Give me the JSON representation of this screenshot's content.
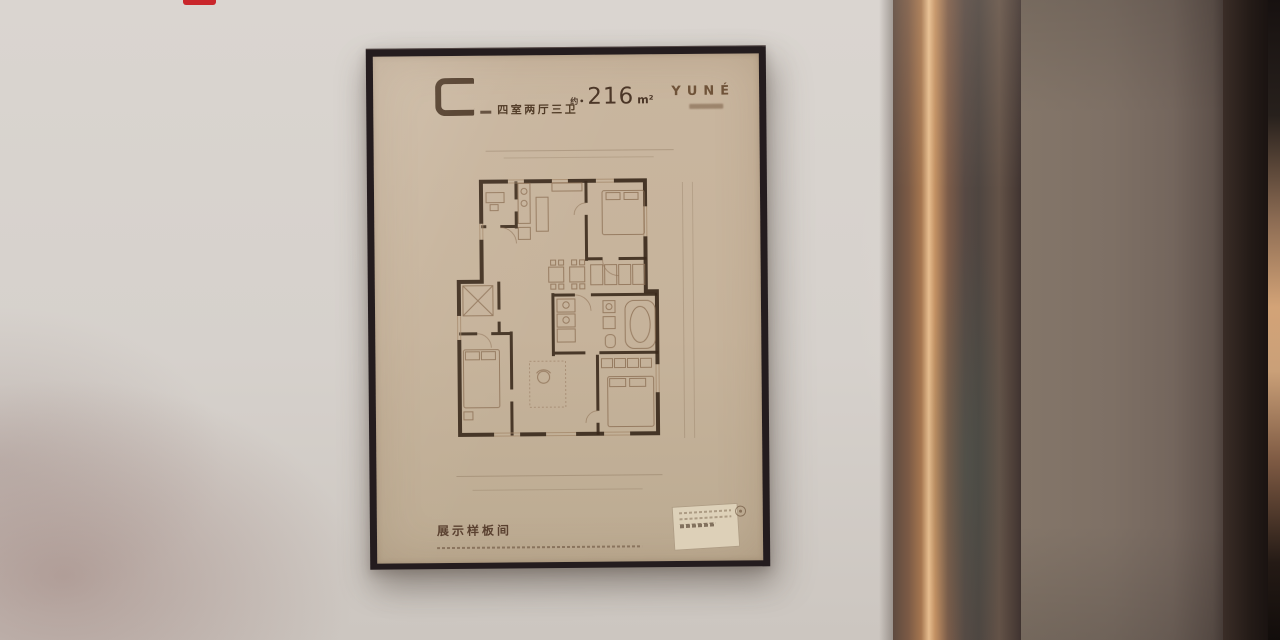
{
  "poster": {
    "unit_label": "C",
    "layout_text": "四室两厅三卫",
    "area_prefix": "约•",
    "area_value": "216",
    "area_unit": "m²",
    "brand": "YUNÉ",
    "footer_title": "展示样板间"
  },
  "marker": {
    "color": "#c9262b"
  },
  "palette": {
    "wall": "#d6d1cc",
    "frame": "#241c1e",
    "poster_background": "#c6b39b",
    "plan_walls": "#3b2a1c",
    "plan_furniture": "#8f7257",
    "title_text": "#4d3722",
    "brand_text": "#6f5339",
    "bronze_highlight": "#e6bd8e",
    "door_panel": "#7e7065"
  }
}
